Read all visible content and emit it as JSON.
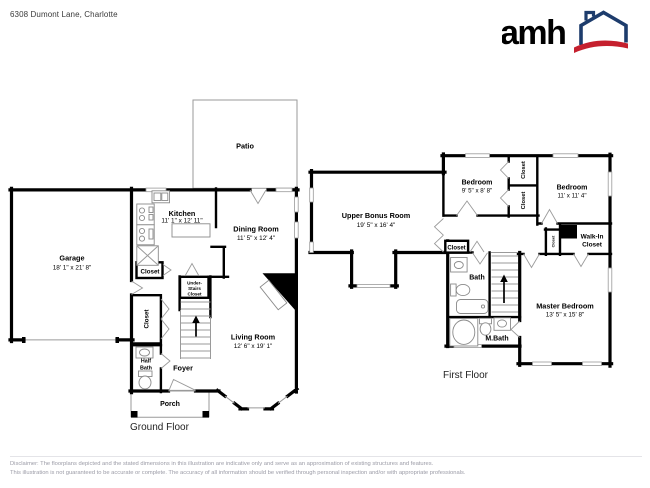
{
  "header": {
    "address": "6308 Dumont Lane, Charlotte",
    "logo_text": "amh"
  },
  "ground_floor": {
    "label": "Ground Floor",
    "rooms": {
      "patio": {
        "name": "Patio"
      },
      "garage": {
        "name": "Garage",
        "dims": "18' 1\" x 21' 8\""
      },
      "kitchen": {
        "name": "Kitchen",
        "dims": "11' 1\" x 12' 11\""
      },
      "dining_room": {
        "name": "Dining Room",
        "dims": "11' 5\" x 12' 4\""
      },
      "living_room": {
        "name": "Living Room",
        "dims": "12' 6\" x 19' 1\""
      },
      "closet_pantry": {
        "name": "Closet"
      },
      "closet_hall": {
        "name": "Closet"
      },
      "under_stairs_closet": {
        "line1": "Under-",
        "line2": "Stairs",
        "line3": "Closet"
      },
      "half_bath": {
        "line1": "Half",
        "line2": "Bath"
      },
      "foyer": {
        "name": "Foyer"
      },
      "porch": {
        "name": "Porch"
      },
      "fireplace": {
        "name": "Fireplace"
      }
    }
  },
  "first_floor": {
    "label": "First Floor",
    "rooms": {
      "upper_bonus_room": {
        "name": "Upper Bonus Room",
        "dims": "19' 5\" x 16' 4\""
      },
      "bedroom_1": {
        "name": "Bedroom",
        "dims": "9' 5\" x 8' 8\""
      },
      "bedroom_2": {
        "name": "Bedroom",
        "dims": "11' x 11' 4\""
      },
      "master_bedroom": {
        "name": "Master Bedroom",
        "dims": "13' 5\" x 15' 8\""
      },
      "bath": {
        "name": "Bath"
      },
      "m_bath": {
        "name": "M.Bath"
      },
      "walk_in_closet": {
        "line1": "Walk-In",
        "line2": "Closet"
      },
      "closet_hall": {
        "name": "Closet"
      },
      "closet_bedroom_a": {
        "name": "Closet"
      },
      "closet_bedroom_b": {
        "name": "Closet"
      },
      "closet_small": {
        "name": "Closet"
      }
    }
  },
  "footer": {
    "disclaimer_line1": "Disclaimer: The floorplans depicted and the stated dimensions in this illustration are indicative only and serve as an approximation of existing structures and features.",
    "disclaimer_line2": "This illustration is not guaranteed to be accurate or complete. The accuracy of all information should be verified through personal inspection and/or with appropriate professionals."
  },
  "colors": {
    "wall": "#000000",
    "thin_line": "#9a9a9a",
    "logo_navy": "#1d3c6c",
    "logo_red": "#c5202e",
    "title_text": "#3a3a3a",
    "disclaimer_text": "#9b9ba6"
  }
}
